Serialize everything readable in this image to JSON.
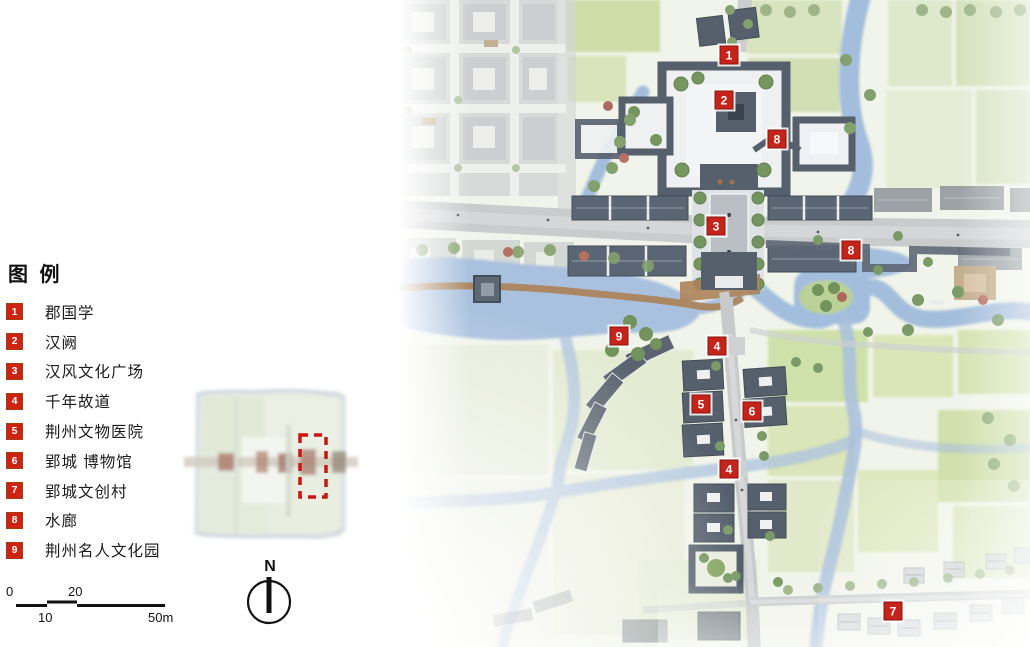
{
  "legend": {
    "title": "图 例",
    "items": [
      {
        "num": "1",
        "label": "郡国学"
      },
      {
        "num": "2",
        "label": "汉阙"
      },
      {
        "num": "3",
        "label": "汉风文化广场"
      },
      {
        "num": "4",
        "label": "千年故道"
      },
      {
        "num": "5",
        "label": "荆州文物医院"
      },
      {
        "num": "6",
        "label": "郢城 博物馆"
      },
      {
        "num": "7",
        "label": "郢城文创村"
      },
      {
        "num": "8",
        "label": "水廊"
      },
      {
        "num": "9",
        "label": "荆州名人文化园"
      }
    ]
  },
  "scale_bar": {
    "start": "0",
    "ten": "10",
    "twenty": "20",
    "end": "50m"
  },
  "north": {
    "label": "N"
  },
  "map": {
    "markers": [
      {
        "label": "1",
        "x": 331,
        "y": 55
      },
      {
        "label": "2",
        "x": 326,
        "y": 100
      },
      {
        "label": "8",
        "x": 379,
        "y": 139
      },
      {
        "label": "3",
        "x": 318,
        "y": 226
      },
      {
        "label": "8",
        "x": 453,
        "y": 250
      },
      {
        "label": "9",
        "x": 221,
        "y": 336
      },
      {
        "label": "4",
        "x": 319,
        "y": 346
      },
      {
        "label": "5",
        "x": 303,
        "y": 404
      },
      {
        "label": "6",
        "x": 354,
        "y": 411
      },
      {
        "label": "4",
        "x": 331,
        "y": 469
      },
      {
        "label": "7",
        "x": 495,
        "y": 611
      }
    ],
    "colors": {
      "marker_red": "#c5241b",
      "water": "#a3bddd",
      "field_green": "#d8e4b8",
      "roof_dark": "#4d5866",
      "road_gray": "#c6c8ca",
      "boardwalk_brown": "#a87c50"
    }
  }
}
